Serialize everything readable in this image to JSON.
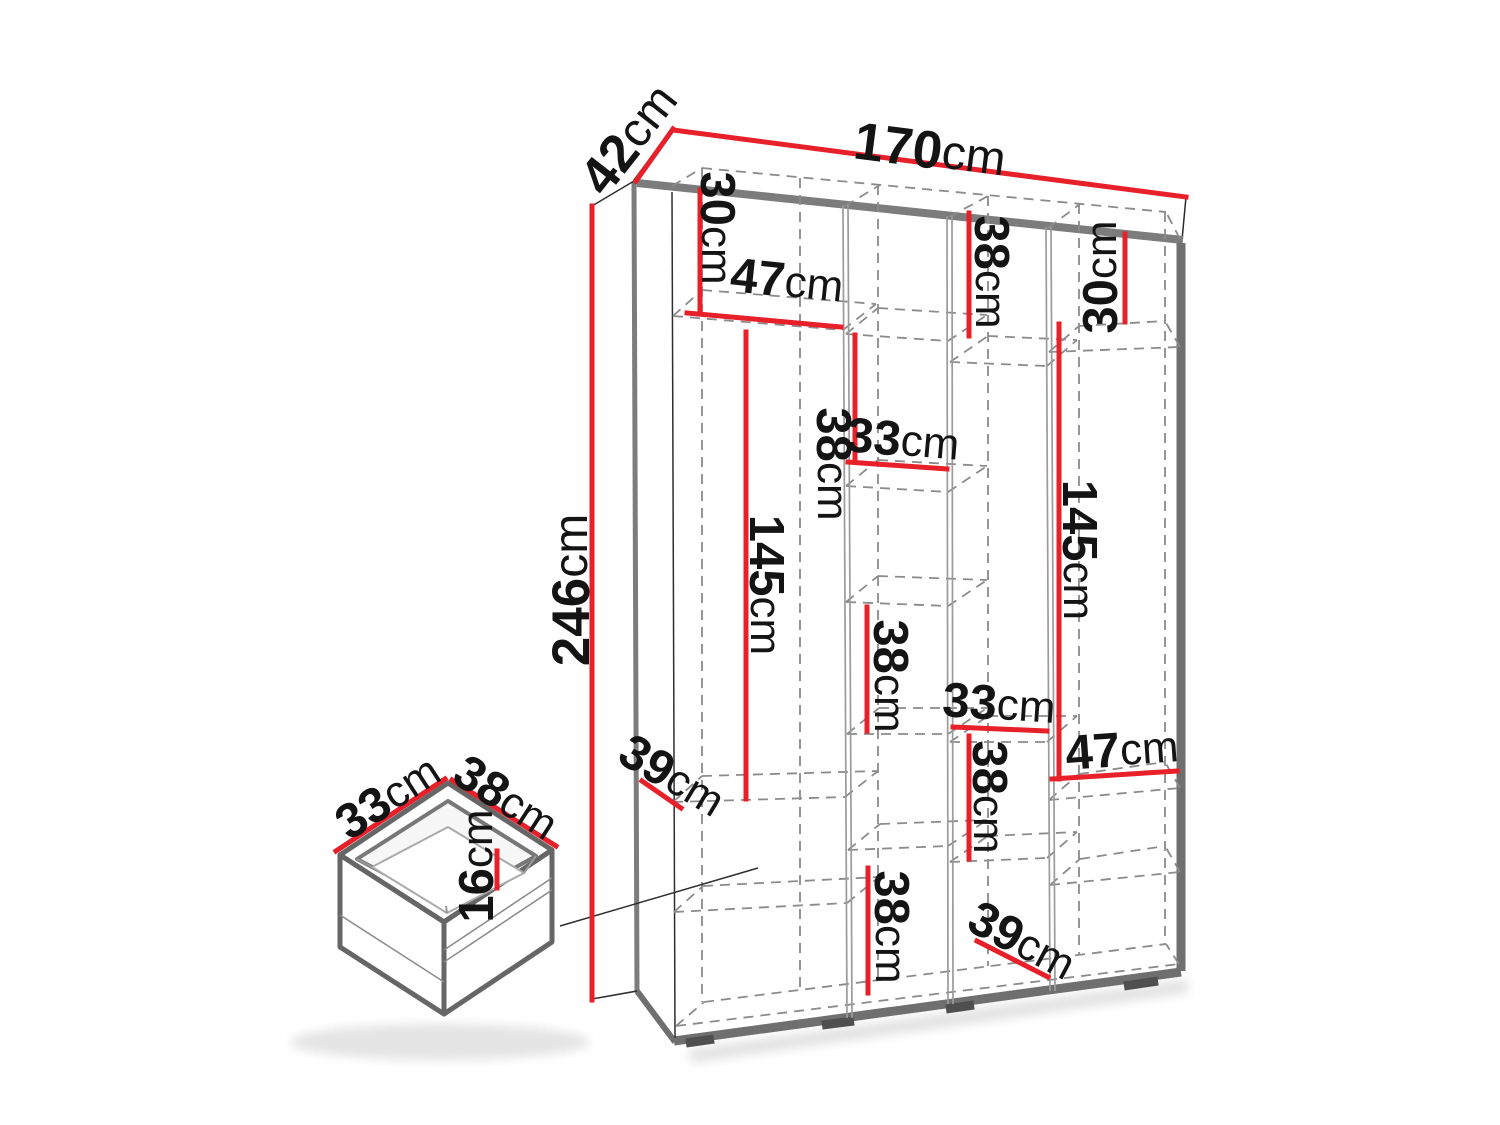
{
  "diagram": {
    "type": "wardrobe-dimension-drawing",
    "unit": "cm",
    "colors": {
      "dimension_lines": "#e8202a",
      "text": "#141414",
      "frame": "#7c7c7c",
      "dashed_interior": "#8b8b8b"
    }
  },
  "labels": {
    "w170": {
      "v": "170",
      "u": "cm"
    },
    "d42": {
      "v": "42",
      "u": "cm"
    },
    "h246": {
      "v": "246",
      "u": "cm"
    },
    "c1_30": {
      "v": "30",
      "u": "cm"
    },
    "c1_47": {
      "v": "47",
      "u": "cm"
    },
    "c1_145": {
      "v": "145",
      "u": "cm"
    },
    "c1_39": {
      "v": "39",
      "u": "cm"
    },
    "c2_38a": {
      "v": "38",
      "u": "cm"
    },
    "c2_33": {
      "v": "33",
      "u": "cm"
    },
    "c2_38b": {
      "v": "38",
      "u": "cm"
    },
    "c2_38c": {
      "v": "38",
      "u": "cm"
    },
    "c3t_38": {
      "v": "38",
      "u": "cm"
    },
    "c3_33": {
      "v": "33",
      "u": "cm"
    },
    "c3_38": {
      "v": "38",
      "u": "cm"
    },
    "c3_39": {
      "v": "39",
      "u": "cm"
    },
    "c4_30": {
      "v": "30",
      "u": "cm"
    },
    "c4_145": {
      "v": "145",
      "u": "cm"
    },
    "c4_47": {
      "v": "47",
      "u": "cm"
    },
    "dr_33": {
      "v": "33",
      "u": "cm"
    },
    "dr_38": {
      "v": "38",
      "u": "cm"
    },
    "dr_16": {
      "v": "16",
      "u": "cm"
    }
  }
}
